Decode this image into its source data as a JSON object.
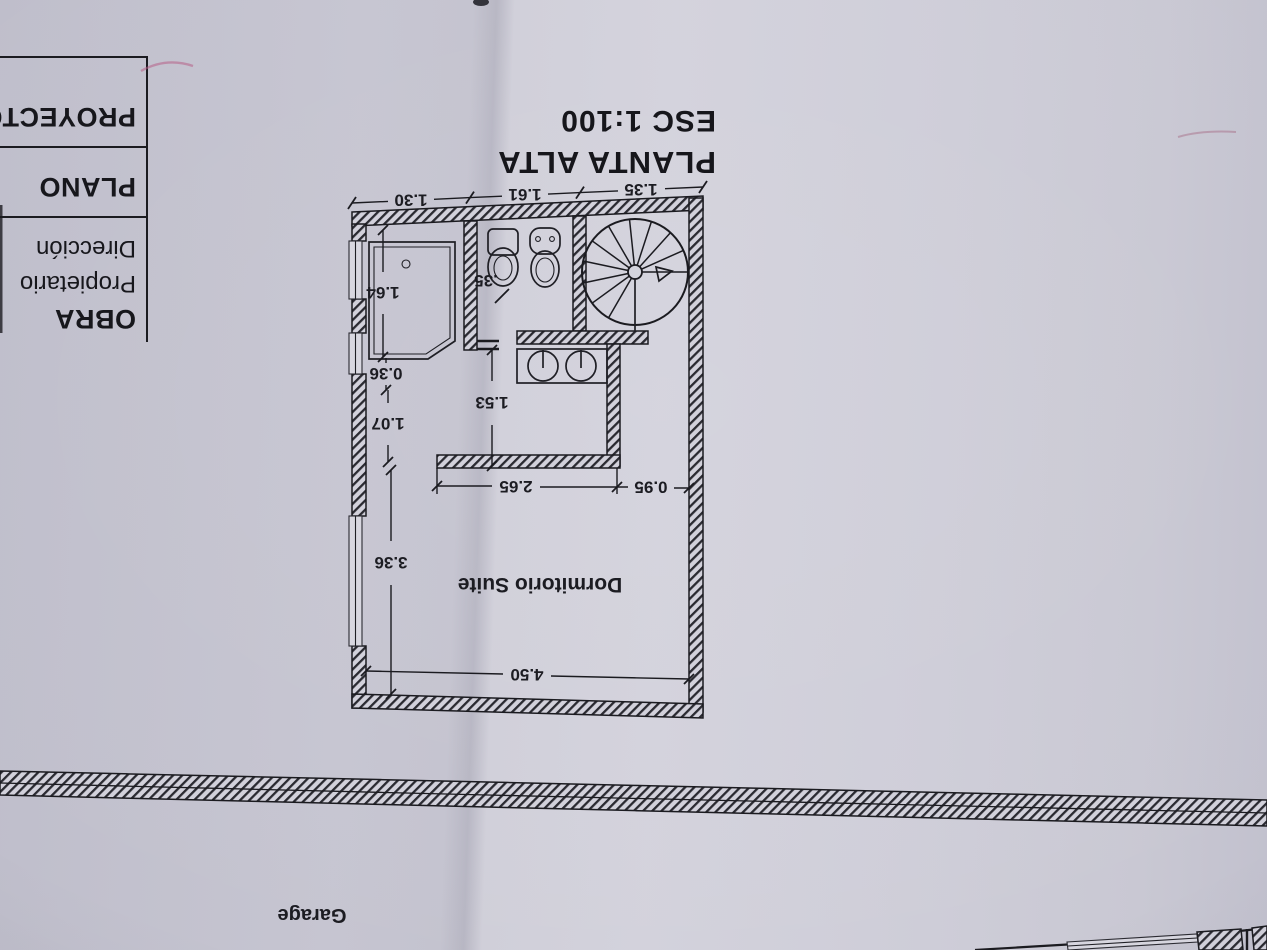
{
  "paper": {
    "base": "#c7c6d2",
    "left_shade": "#c2c1cd",
    "right_shade": "#d0cfd9",
    "ink": "#1b1b20"
  },
  "marks": {
    "pink": "#b65f86"
  },
  "title_block": {
    "obra": "OBRA",
    "propietario": "Propietario",
    "direccion": "Dirección",
    "plano": "PLANO",
    "proyecto": "PROYECTO"
  },
  "plan_title": {
    "title": "PLANTA ALTA",
    "scale": "ESC 1:100"
  },
  "rooms": {
    "suite": "Dormitorio Suite",
    "garage": "Garage"
  },
  "dims": {
    "top_left": "1.30",
    "top_mid": "1.61",
    "top_right": "1.35",
    "shower_h": "1.64",
    "sill": "0.36",
    "pass": "1.07",
    "suite_h": "3.36",
    "bidet_gap": ".35",
    "bath_w": "1.53",
    "suite_w1": "2.65",
    "suite_w2": "0.95",
    "suite_w": "4.50"
  }
}
